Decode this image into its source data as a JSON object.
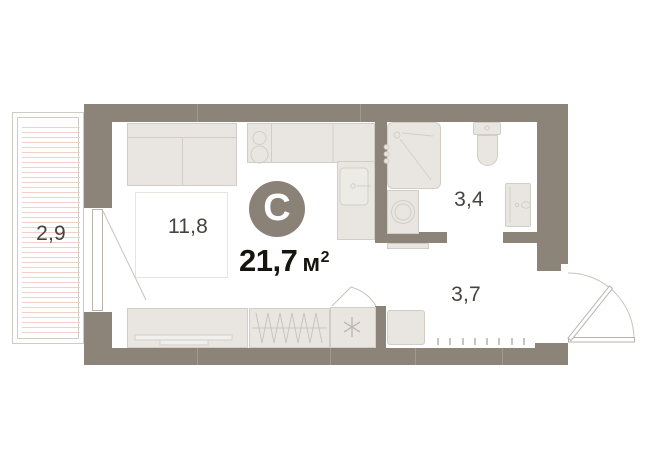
{
  "plan": {
    "badge": "С",
    "area": {
      "value": "21,7",
      "unit": "м",
      "superscript": "2"
    },
    "rooms": {
      "balcony": {
        "label": "2,9"
      },
      "living": {
        "label": "11,8"
      },
      "bathroom": {
        "label": "3,4"
      },
      "hallway": {
        "label": "3,7"
      }
    },
    "icons": {
      "closet_marker": "✳"
    }
  },
  "colors": {
    "wall": "#8c8379",
    "furniture_fill": "#e9e6e1",
    "furniture_line": "#d2cec7",
    "hatch": "#f2cfc8",
    "thin_line": "#c9c4bd",
    "door_line": "#b7b2ab",
    "label_text": "#46423f",
    "area_text": "#17140f",
    "badge_bg": "#8a8177",
    "badge_text": "#ffffff",
    "frame_line": "#cfccc5",
    "background": "#ffffff"
  }
}
